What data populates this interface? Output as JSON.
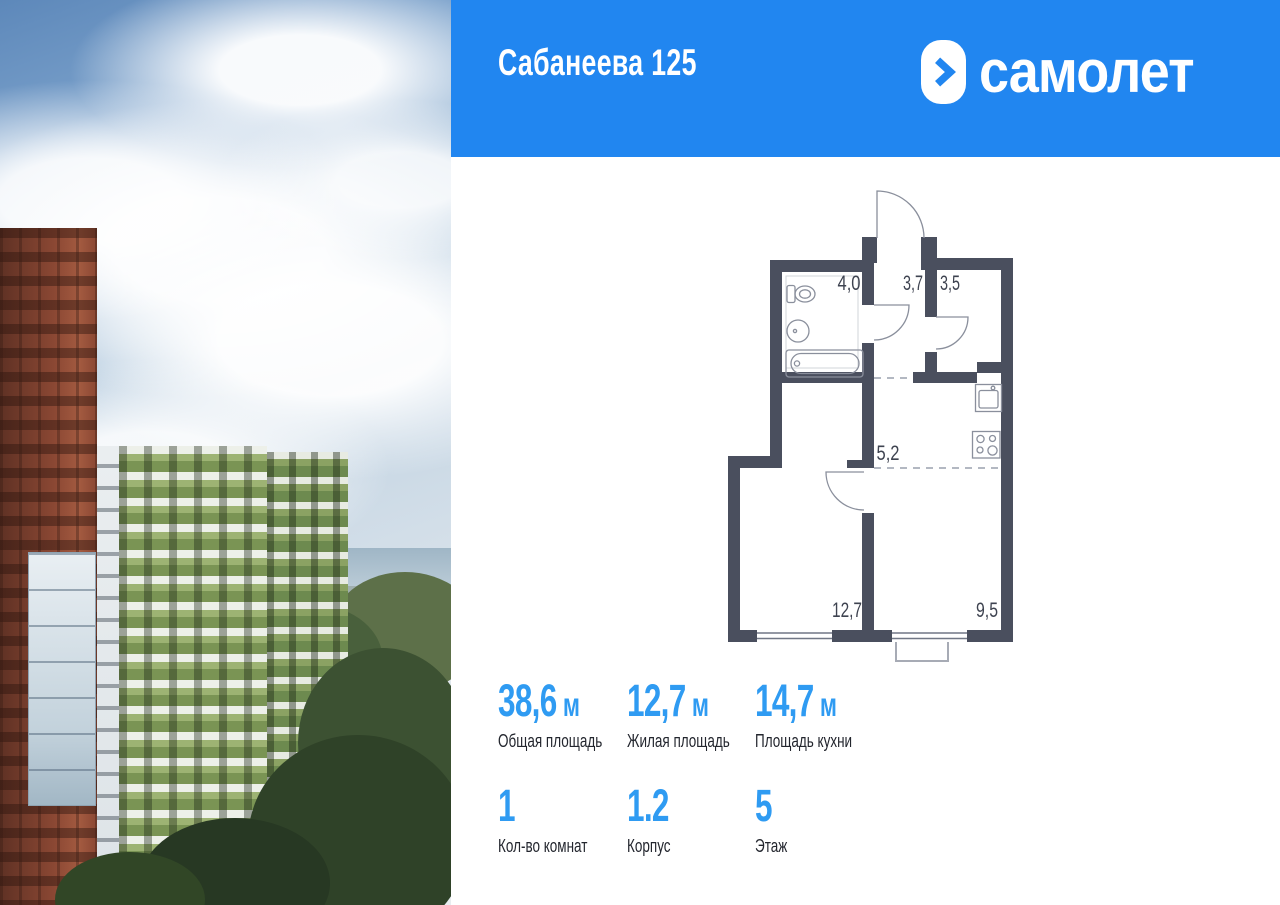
{
  "header": {
    "title": "Сабанеева 125",
    "logo_text": "самолет",
    "bg_color": "#2186F0"
  },
  "photo": {
    "description": "Residential complex photo: red-brown brick tower on the left, green-and-white striped apartment buildings, sky with clouds, sea horizon and forest"
  },
  "floor_plan": {
    "wall_color": "#4A4F5E",
    "rooms": [
      {
        "name": "bathroom",
        "label": "4,0"
      },
      {
        "name": "hallway",
        "label": "3,7"
      },
      {
        "name": "pantry",
        "label": "3,5"
      },
      {
        "name": "corridor",
        "label": "5,2"
      },
      {
        "name": "living-room",
        "label": "12,7"
      },
      {
        "name": "kitchen",
        "label": "9,5"
      }
    ]
  },
  "stats": {
    "accent_color": "#2F9BF2",
    "row1": [
      {
        "value": "38,6",
        "unit": "м",
        "label": "Общая площадь"
      },
      {
        "value": "12,7",
        "unit": "м",
        "label": "Жилая площадь"
      },
      {
        "value": "14,7",
        "unit": "м",
        "label": "Площадь кухни"
      }
    ],
    "row2": [
      {
        "value": "1",
        "label": "Кол-во комнат"
      },
      {
        "value": "1.2",
        "label": "Корпус"
      },
      {
        "value": "5",
        "label": "Этаж"
      }
    ]
  }
}
